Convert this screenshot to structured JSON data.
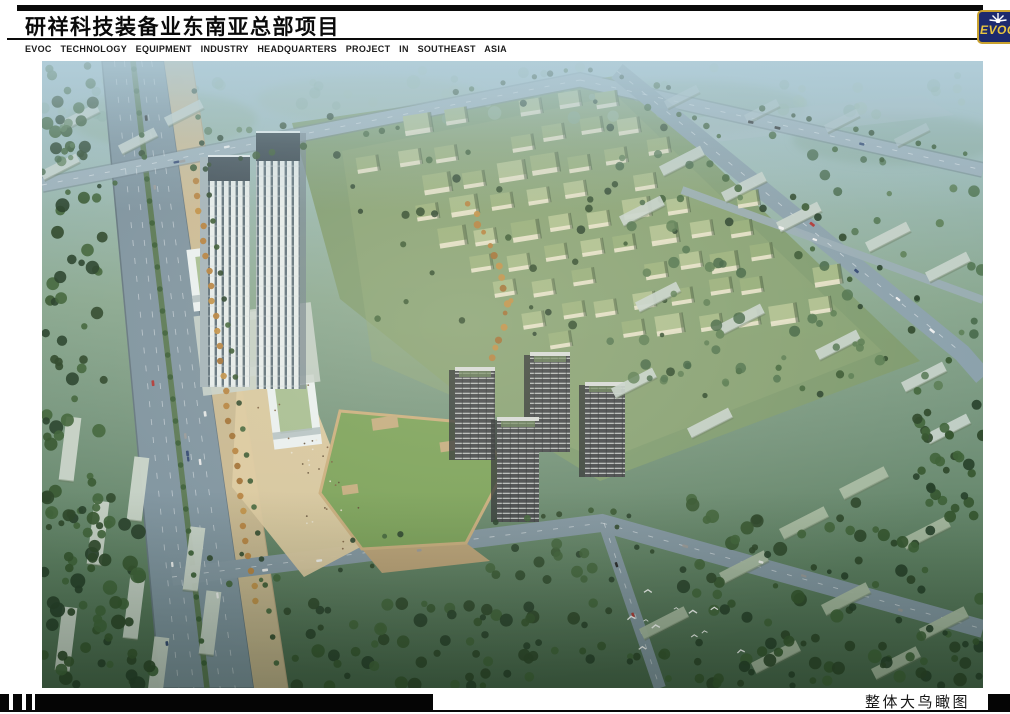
{
  "header": {
    "title_cn": "研祥科技装备业东南亚总部项目",
    "title_en": "EVOC TECHNOLOGY EQUIPMENT INDUSTRY HEADQUARTERS PROJECT IN SOUTHEAST ASIA",
    "logo": {
      "text": "EVOC",
      "icon": "sunburst-icon"
    }
  },
  "footer": {
    "caption": "整体大鸟瞰图"
  },
  "colors": {
    "ink": "#0a0a0a",
    "page-bg": "#ffffff",
    "logo-navy": "#1d2a6e",
    "logo-gold": "#e8c53f",
    "logo-border": "#c9a22f",
    "caption-ink": "#161616"
  }
}
